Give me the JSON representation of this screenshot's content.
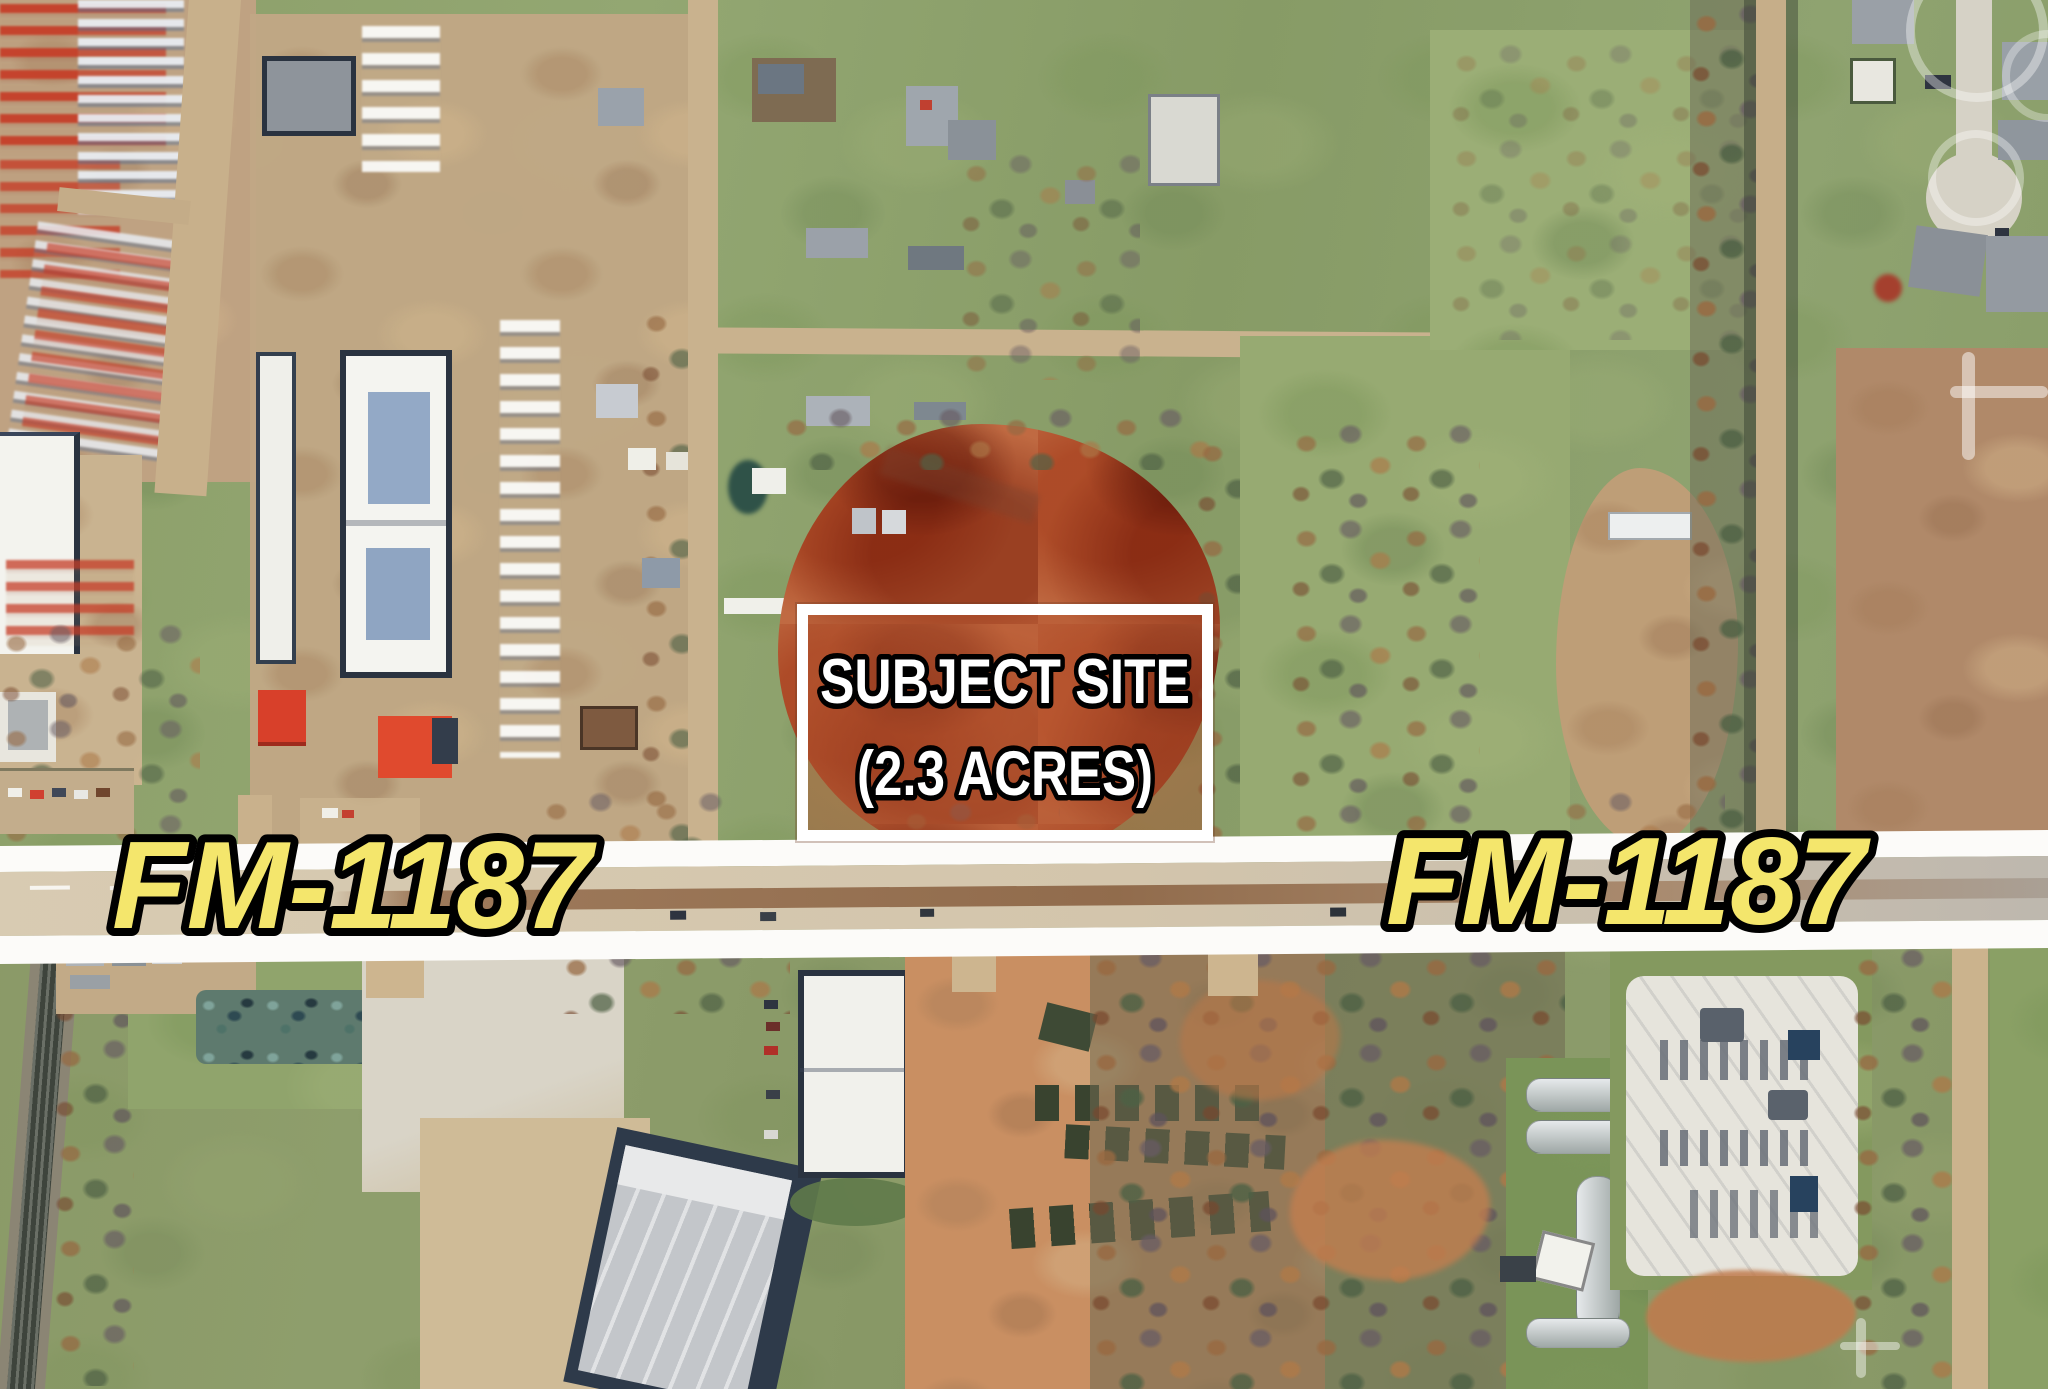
{
  "map": {
    "type": "aerial-satellite-photo",
    "description": "Low-altitude aerial of a commercial corridor; subject parcel outlined north of the highway"
  },
  "annotations": {
    "subject_site": {
      "line1": "SUBJECT SITE",
      "line2": "(2.3 ACRES)",
      "text_color": "#FFFFFF",
      "outline_color": "#000000",
      "box_border_color": "#FFFFFF"
    },
    "road_labels": {
      "left": "FM-1187",
      "right": "FM-1187",
      "text_color": "#F4E66C",
      "outline_color": "#000000"
    },
    "road_band_color": "#FCFBF9"
  }
}
